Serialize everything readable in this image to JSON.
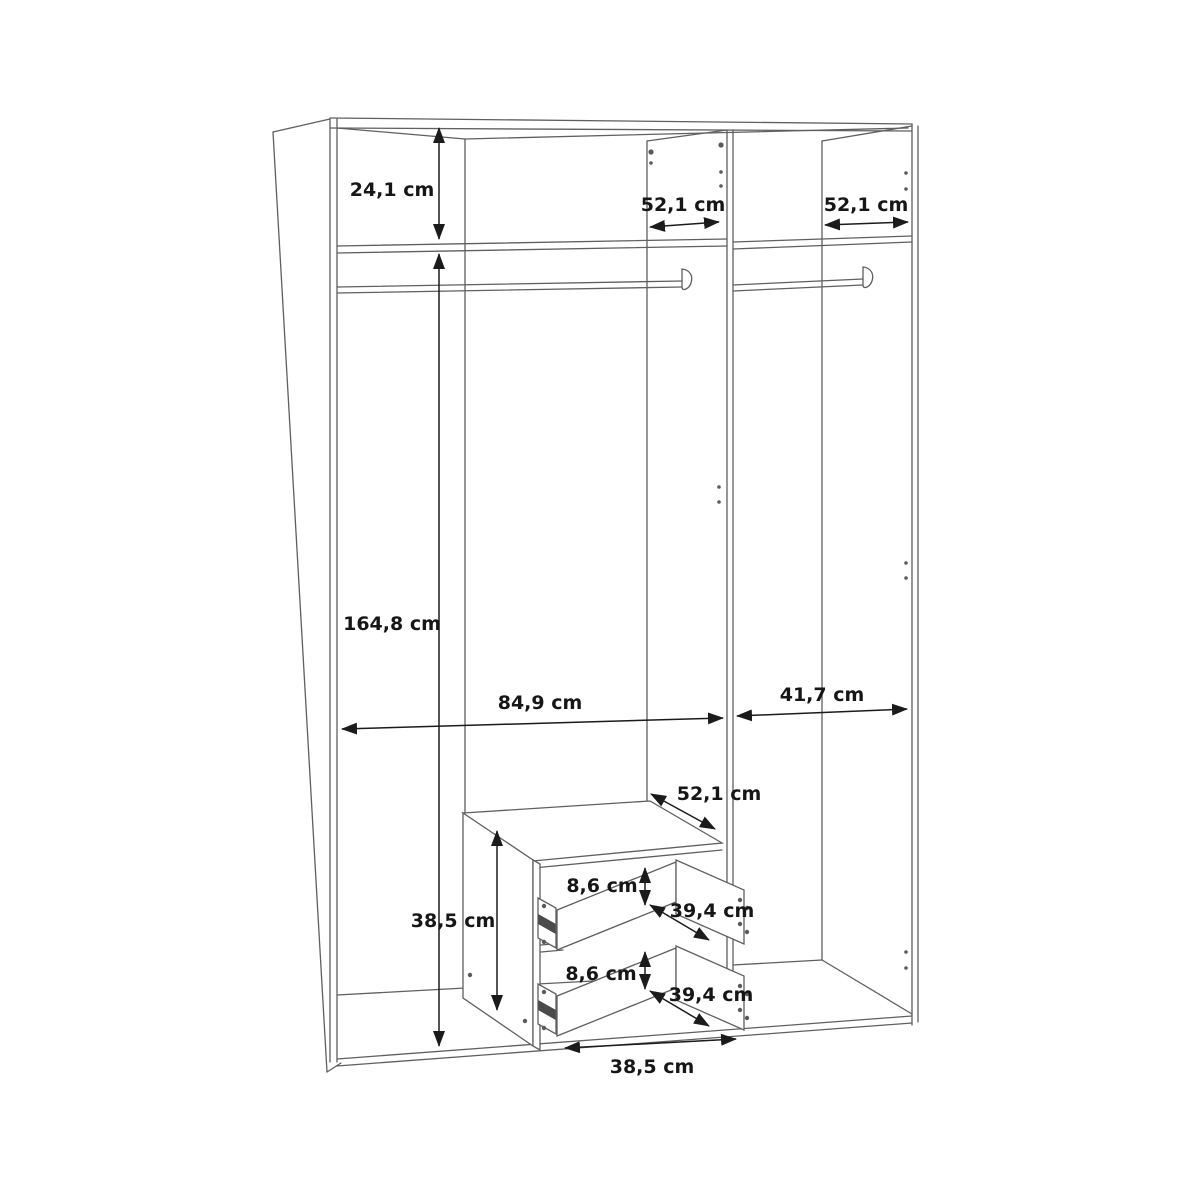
{
  "diagram": {
    "type": "furniture-dimension-drawing",
    "subject": "wardrobe interior with top shelf, two hanging rails, center divider and two-drawer unit",
    "unit": "cm",
    "colors": {
      "background": "#ffffff",
      "cabinet_line": "#5f5f5f",
      "dimension_line": "#1b1b1b",
      "text": "#161616"
    },
    "dimensions": [
      {
        "name": "top-shelf-section-height",
        "label": "24,1 cm",
        "value": 24.1
      },
      {
        "name": "top-shelf-depth-left",
        "label": "52,1 cm",
        "value": 52.1
      },
      {
        "name": "top-shelf-depth-right",
        "label": "52,1 cm",
        "value": 52.1
      },
      {
        "name": "hanging-section-height",
        "label": "164,8 cm",
        "value": 164.8
      },
      {
        "name": "left-compartment-width",
        "label": "84,9 cm",
        "value": 84.9
      },
      {
        "name": "right-compartment-width",
        "label": "41,7 cm",
        "value": 41.7
      },
      {
        "name": "drawer-unit-depth",
        "label": "52,1 cm",
        "value": 52.1
      },
      {
        "name": "drawer-unit-height",
        "label": "38,5 cm",
        "value": 38.5
      },
      {
        "name": "upper-drawer-front-height",
        "label": "8,6 cm",
        "value": 8.6
      },
      {
        "name": "upper-drawer-depth",
        "label": "39,4 cm",
        "value": 39.4
      },
      {
        "name": "lower-drawer-front-height",
        "label": "8,6 cm",
        "value": 8.6
      },
      {
        "name": "lower-drawer-depth",
        "label": "39,4 cm",
        "value": 39.4
      },
      {
        "name": "drawer-unit-width",
        "label": "38,5 cm",
        "value": 38.5
      }
    ]
  }
}
